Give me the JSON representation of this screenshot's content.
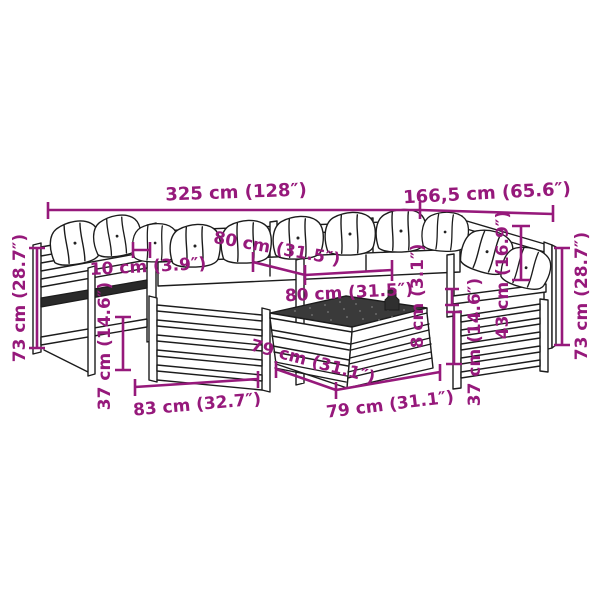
{
  "image_type": "product dimension diagram",
  "product": "pallet-style garden lounge set with corner sofas and coffee table",
  "colors": {
    "background": "#ffffff",
    "dimension_annotation": "#96197B",
    "line_art": "#1c1c1c",
    "table_top": "#3a3a3a"
  },
  "dims": {
    "total_width": {
      "label": "325 cm (128″)"
    },
    "right_width": {
      "label": "166,5 cm (65.6″)"
    },
    "seat_width": {
      "label": "80 cm (31.5″)"
    },
    "armrest_width": {
      "label": "10 cm (3.9″)"
    },
    "table_top_width": {
      "label": "80 cm (31.5″)"
    },
    "tabletop_thickness": {
      "label": "8 cm (3.1″)"
    },
    "backrest_height": {
      "label": "43 cm (16.9″)"
    },
    "height_left": {
      "label": "73 cm (28.7″)"
    },
    "height_right": {
      "label": "73 cm (28.7″)"
    },
    "seat_height_left": {
      "label": "37 cm (14.6″)"
    },
    "seat_height_right": {
      "label": "37 cm (14.6″)"
    },
    "module_depth": {
      "label": "83 cm (32.7″)"
    },
    "table_depth": {
      "label": "79 cm (31.1″)"
    },
    "table_width": {
      "label": "79 cm (31.1″)"
    }
  }
}
